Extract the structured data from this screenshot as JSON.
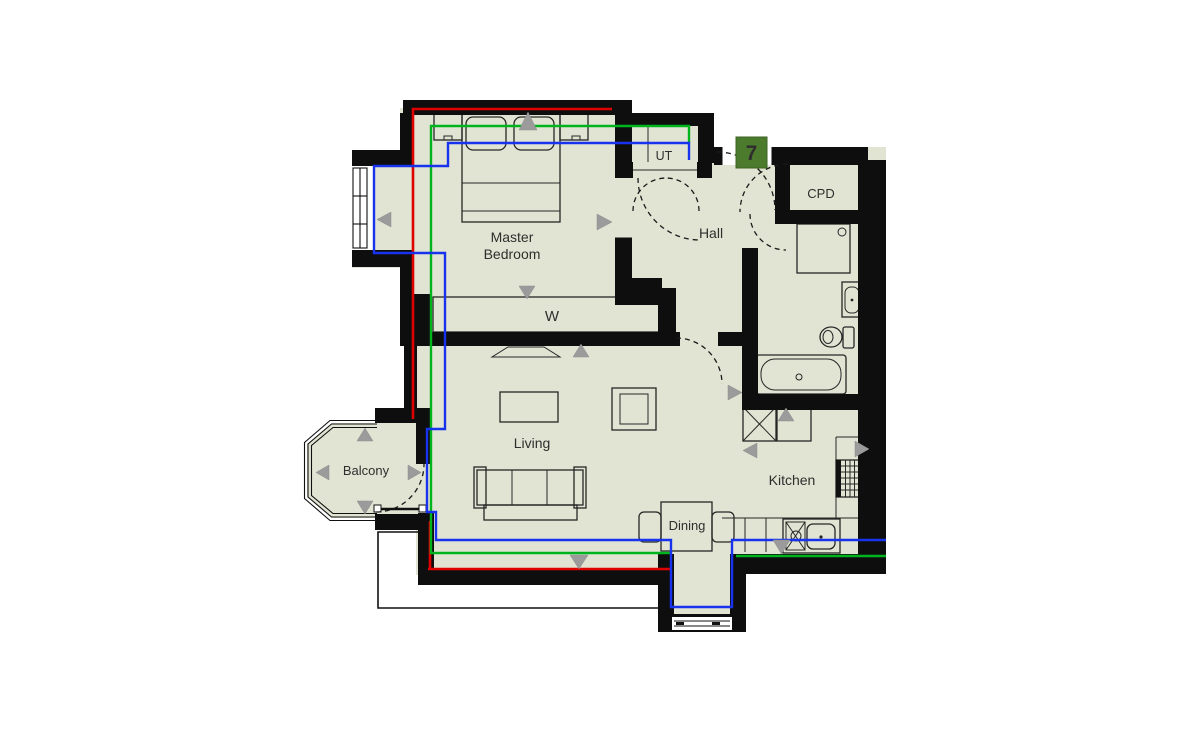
{
  "plan": {
    "badge": {
      "number": "7",
      "color": "#4d7b2d",
      "text_color": "#ffffff"
    },
    "labels": {
      "master_bedroom_line1": "Master",
      "master_bedroom_line2": "Bedroom",
      "wardrobe": "W",
      "utility": "UT",
      "hall": "Hall",
      "cupboard": "CPD",
      "living": "Living",
      "balcony": "Balcony",
      "kitchen": "Kitchen",
      "dining": "Dining"
    },
    "colors": {
      "floor": "#e2e4d3",
      "wall": "#0e0e0e",
      "line_red": "#df0000",
      "line_green": "#00b41e",
      "line_blue": "#1733ee",
      "arrow": "#9b9b9b"
    },
    "measurement_lines": [
      {
        "name": "red-line",
        "color": "#df0000"
      },
      {
        "name": "green-line",
        "color": "#00b41e"
      },
      {
        "name": "blue-line",
        "color": "#1733ee"
      }
    ],
    "rooms": [
      "Master Bedroom",
      "Hall",
      "UT",
      "CPD",
      "Living",
      "Balcony",
      "Kitchen",
      "Dining"
    ],
    "furniture": [
      "double-bed",
      "bedside-tables",
      "wardrobe",
      "tv-unit",
      "coffee-table",
      "side-table",
      "sofa",
      "dining-table",
      "dining-chairs",
      "kitchen-counter",
      "hob",
      "kitchen-sink",
      "appliance-space",
      "shower",
      "basin",
      "wc",
      "bath"
    ],
    "arrow_markers": [
      "up",
      "down",
      "left",
      "right"
    ]
  }
}
